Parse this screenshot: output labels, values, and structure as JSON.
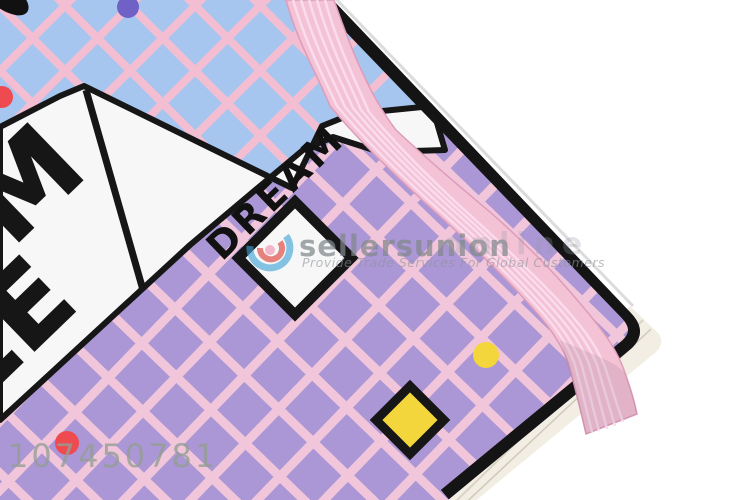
{
  "photo": {
    "subject": "notebook-cover-corner",
    "cover_text": {
      "big_line1": "M",
      "big_line2": "LE",
      "small_word": "DREAM"
    },
    "colors": {
      "blue_area": "#a6c6ef",
      "blue_grid_line": "#f3bdd2",
      "purple_area": "#ab97d6",
      "purple_grid_line": "#f1c6da",
      "band_pink": "#f4c2d5",
      "band_stripe": "#fadced",
      "accent_yellow": "#f2d63c",
      "accent_red": "#ee4a4f",
      "accent_purple_dot": "#7061c6",
      "ink_black": "#161616",
      "page_edge": "#f2eee3"
    }
  },
  "watermark": {
    "brand": "sellersunion",
    "brand_suffix": "online",
    "tagline": "Provide Trade Services For Global Customers",
    "id_number": "107450781"
  }
}
